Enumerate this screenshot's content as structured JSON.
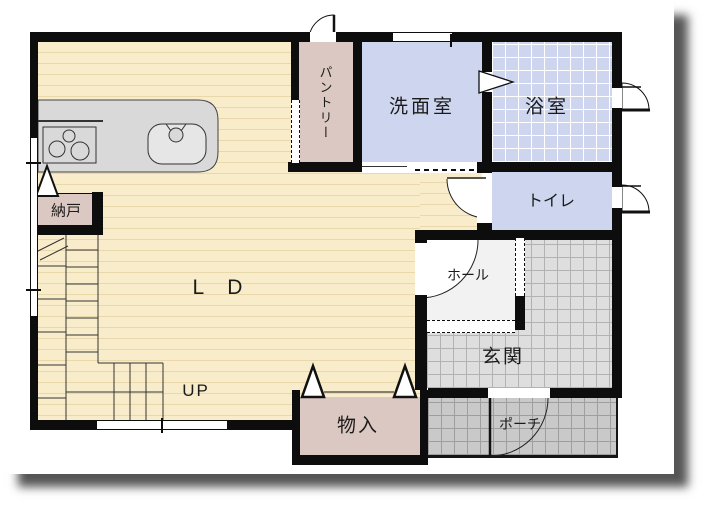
{
  "plan": {
    "type": "floor-plan",
    "floor": "1F"
  },
  "rooms": {
    "ld": {
      "label": "L D"
    },
    "up": {
      "label": "UP"
    },
    "pantry": {
      "label": "パントリー"
    },
    "washroom": {
      "label": "洗面室"
    },
    "bath": {
      "label": "浴室"
    },
    "toilet": {
      "label": "トイレ"
    },
    "hall": {
      "label": "ホール"
    },
    "entrance": {
      "label": "玄関"
    },
    "porch": {
      "label": "ポーチ"
    },
    "storage_closet": {
      "label": "物入"
    },
    "storage_room": {
      "label": "納戸"
    }
  },
  "colors": {
    "wall": "#0d0d0d",
    "ld_floor": "#f8ecca",
    "ld_stripe": "#e9d8ab",
    "storage_fill": "#dcc8c2",
    "wet_room_fill": "#cdd5ef",
    "hall_fill": "#f2f2f2",
    "entrance_tile": "#dedede",
    "porch_tile": "#c9c9c9",
    "counter_fill": "#d9d9d9"
  }
}
